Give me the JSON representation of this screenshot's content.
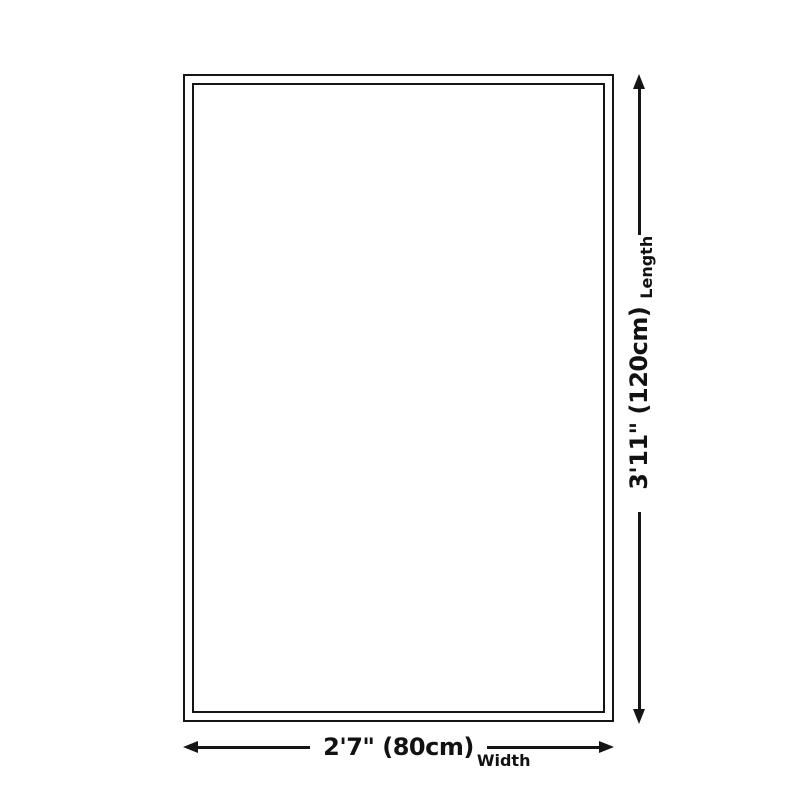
{
  "diagram": {
    "title": "rug-size-diagram",
    "width_label": {
      "main": "2'7\" (80cm)",
      "sub": "Width"
    },
    "length_label": {
      "main": "3'11\" (120cm)",
      "sub": "Length"
    },
    "colors": {
      "background": "#ffffff",
      "rug_fill": "#ffffff",
      "ink": "#151515"
    }
  }
}
